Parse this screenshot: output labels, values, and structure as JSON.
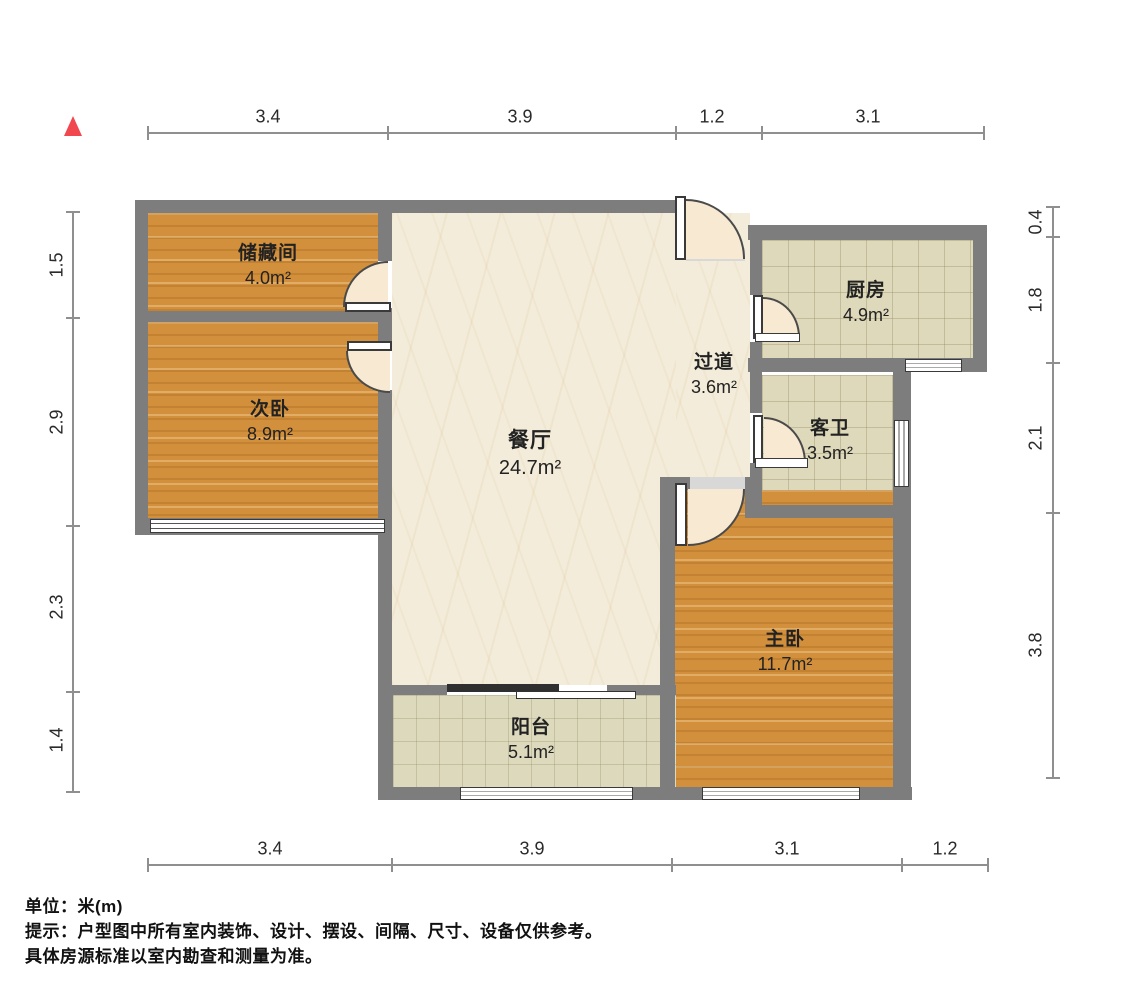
{
  "plan": {
    "type": "residential-floor-plan",
    "north_marker": "north-arrow"
  },
  "dimensions": {
    "top": [
      "3.4",
      "3.9",
      "1.2",
      "3.1"
    ],
    "bottom": [
      "3.4",
      "3.9",
      "3.1",
      "1.2"
    ],
    "left": [
      "1.5",
      "2.9",
      "2.3",
      "1.4"
    ],
    "right": [
      "0.4",
      "1.8",
      "2.1",
      "3.8"
    ]
  },
  "rooms": {
    "storage": {
      "name": "储藏间",
      "area": "4.0m²"
    },
    "secondary_bedroom": {
      "name": "次卧",
      "area": "8.9m²"
    },
    "dining": {
      "name": "餐厅",
      "area": "24.7m²"
    },
    "hallway": {
      "name": "过道",
      "area": "3.6m²"
    },
    "kitchen": {
      "name": "厨房",
      "area": "4.9m²"
    },
    "guest_bathroom": {
      "name": "客卫",
      "area": "3.5m²"
    },
    "master_bedroom": {
      "name": "主卧",
      "area": "11.7m²"
    },
    "balcony": {
      "name": "阳台",
      "area": "5.1m²"
    }
  },
  "footer": {
    "unit_line": "单位：米(m)",
    "note_line1": "提示：户型图中所有室内装饰、设计、摆设、间隔、尺寸、设备仅供参考。",
    "note_line2": "具体房源标准以室内勘查和测量为准。"
  },
  "colors": {
    "wall": "#7d7d7d",
    "wood_floor": "#d3903c",
    "marble_floor": "#f3ecda",
    "tile_floor": "#ded9ba",
    "north_arrow": "#f0484e"
  }
}
